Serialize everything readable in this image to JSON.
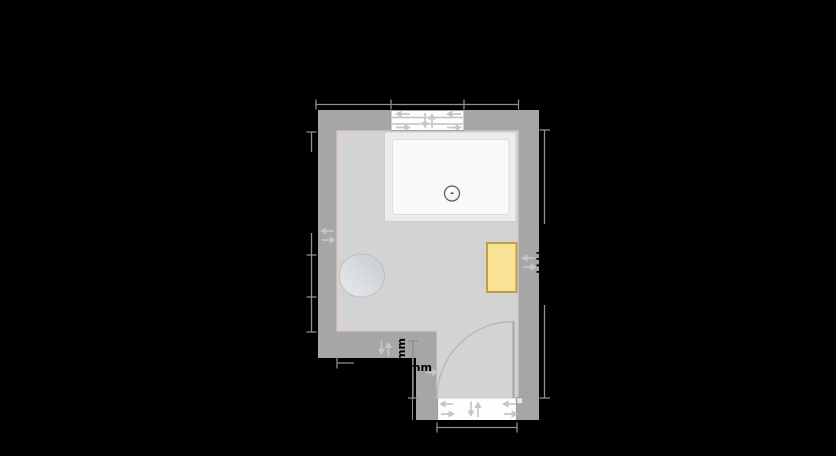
{
  "floorplan": {
    "labels": {
      "wall_segment_dimension": "mm",
      "door_offset_dimension": "mm",
      "dimension_unit": "mm"
    },
    "colors": {
      "canvas": "#000000",
      "wall": "#a6a6a6",
      "floor": "#d3d3d3",
      "floor_edge": "#dfc6be",
      "opening_white": "#fdfdfd",
      "shower_tray": "#ececec",
      "radiator_fill": "#f8e295",
      "radiator_border": "#c09e43",
      "toilet_gradient_dark": "#c6cbd2",
      "toilet_gradient_light": "#e9ebed",
      "dimension_line": "#8e8e8e",
      "dimension_text": "#000000",
      "handle_arrow": "#c6c6c6"
    },
    "fixtures": [
      {
        "name": "shower-tray"
      },
      {
        "name": "shower-drain"
      },
      {
        "name": "toilet"
      },
      {
        "name": "radiator"
      },
      {
        "name": "window"
      },
      {
        "name": "door"
      }
    ]
  }
}
